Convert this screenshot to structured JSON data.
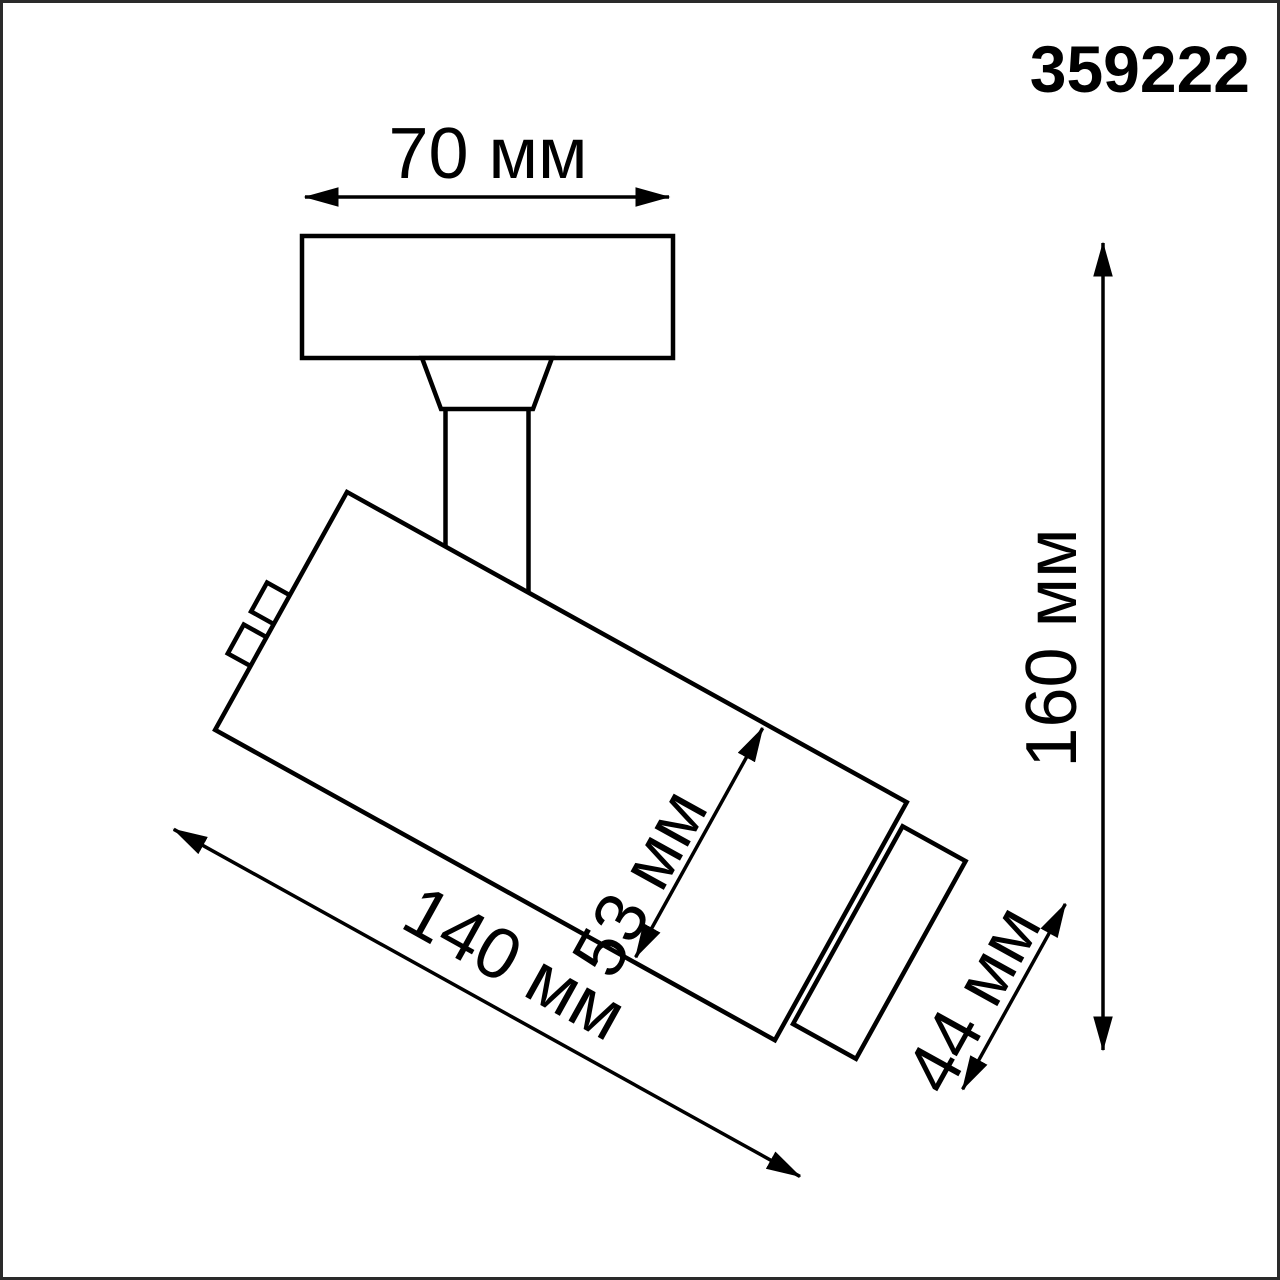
{
  "product": {
    "code": "359222"
  },
  "dimensions": {
    "base_width": {
      "label": "70 мм",
      "value": 70,
      "unit": "мм"
    },
    "body_diameter": {
      "label": "53 мм",
      "value": 53,
      "unit": "мм"
    },
    "total_length": {
      "label": "140 мм",
      "value": 140,
      "unit": "мм"
    },
    "head_diameter": {
      "label": "44 мм",
      "value": 44,
      "unit": "мм"
    },
    "total_height": {
      "label": "160 мм",
      "value": 160,
      "unit": "мм"
    }
  },
  "colors": {
    "ink": "#000000",
    "frame": "#2a2a2a",
    "background": "#ffffff"
  }
}
